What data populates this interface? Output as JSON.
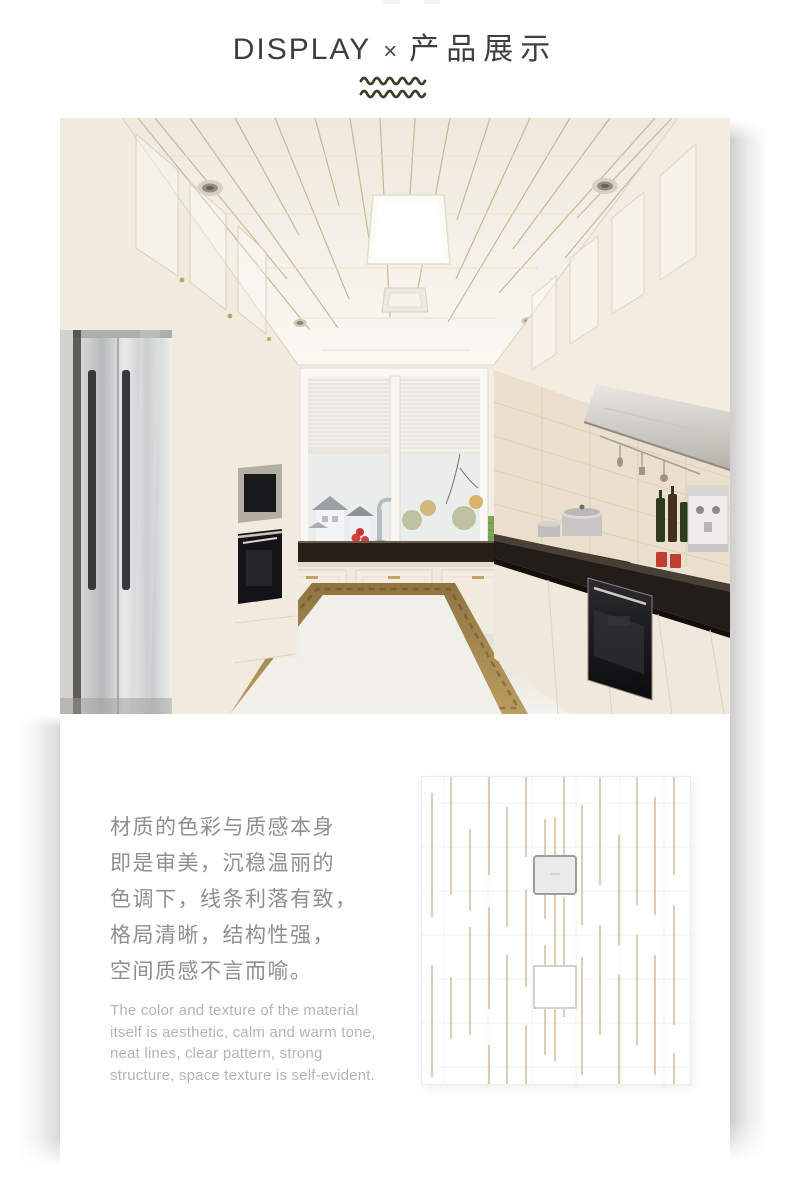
{
  "header": {
    "title_en": "DISPLAY",
    "title_sep": "×",
    "title_zh": "产品展示"
  },
  "description": {
    "zh_lines": [
      "材质的色彩与质感本身",
      "即是审美，沉稳温丽的",
      "色调下，线条利落有致，",
      "格局清晰，结构性强，",
      "空间质感不言而喻。"
    ],
    "en_lines": [
      "The color and texture of the material",
      "itself is aesthetic, calm and warm tone,",
      "neat lines, clear pattern, strong",
      "structure, space texture is self-evident."
    ]
  },
  "palette": {
    "title_color": "#3e3e3e",
    "wave_color": "#3b3f2a",
    "zh_text_color": "#8f8f8f",
    "en_text_color": "#b4b4b4",
    "gold_accent": "#c8a86a",
    "swatch_line_color": "#c49a6c",
    "ceiling_cream": "#efe8dc",
    "counter_dark": "#221d18"
  }
}
